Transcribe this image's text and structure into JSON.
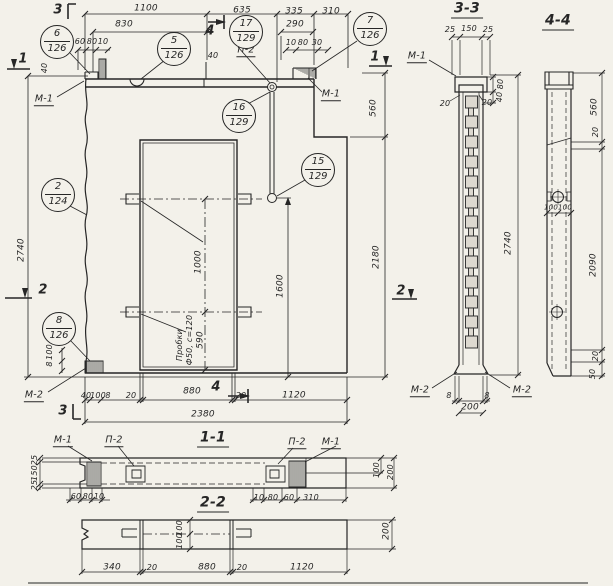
{
  "colors": {
    "paper": "#f3f1ea",
    "ink": "#262626",
    "cell": "#ddd9d0"
  },
  "view_titles": [
    {
      "t": "3-3",
      "x": 467,
      "y": 10,
      "n": "section-title-3-3"
    },
    {
      "t": "4-4",
      "x": 558,
      "y": 22,
      "n": "section-title-4-4"
    },
    {
      "t": "1-1",
      "x": 213,
      "y": 439,
      "n": "section-title-1-1"
    },
    {
      "t": "2-2",
      "x": 213,
      "y": 504,
      "n": "section-title-2-2"
    }
  ],
  "callouts": [
    {
      "top": "6",
      "bot": "126",
      "x": 57,
      "y": 42
    },
    {
      "top": "5",
      "bot": "126",
      "x": 174,
      "y": 49
    },
    {
      "top": "17",
      "bot": "129",
      "x": 246,
      "y": 32
    },
    {
      "top": "7",
      "bot": "126",
      "x": 370,
      "y": 29
    },
    {
      "top": "16",
      "bot": "129",
      "x": 239,
      "y": 116
    },
    {
      "top": "15",
      "bot": "129",
      "x": 318,
      "y": 170
    },
    {
      "top": "2",
      "bot": "124",
      "x": 58,
      "y": 195
    },
    {
      "top": "8",
      "bot": "126",
      "x": 59,
      "y": 329
    }
  ],
  "cut_labels": [
    {
      "t": "3",
      "x": 58,
      "y": 10
    },
    {
      "t": "4",
      "x": 210,
      "y": 31
    },
    {
      "t": "1",
      "x": 23,
      "y": 59
    },
    {
      "t": "1",
      "x": 375,
      "y": 57
    },
    {
      "t": "2",
      "x": 43,
      "y": 290
    },
    {
      "t": "2",
      "x": 401,
      "y": 291
    },
    {
      "t": "3",
      "x": 63,
      "y": 411
    },
    {
      "t": "4",
      "x": 216,
      "y": 387
    }
  ],
  "ref_labels": [
    {
      "t": "М-1",
      "x": 44,
      "y": 100
    },
    {
      "t": "М-1",
      "x": 331,
      "y": 95
    },
    {
      "t": "П-2",
      "x": 246,
      "y": 51
    },
    {
      "t": "М-2",
      "x": 34,
      "y": 396
    },
    {
      "t": "М-1",
      "x": 417,
      "y": 57
    },
    {
      "t": "М-2",
      "x": 420,
      "y": 391
    },
    {
      "t": "М-2",
      "x": 522,
      "y": 391
    },
    {
      "t": "М-1",
      "x": 63,
      "y": 441
    },
    {
      "t": "П-2",
      "x": 114,
      "y": 441
    },
    {
      "t": "П-2",
      "x": 297,
      "y": 443
    },
    {
      "t": "М-1",
      "x": 331,
      "y": 443
    }
  ],
  "texts": [
    {
      "t": "1100",
      "x": 146,
      "y": 9
    },
    {
      "t": "635",
      "x": 242,
      "y": 11
    },
    {
      "t": "335",
      "x": 294,
      "y": 12
    },
    {
      "t": "310",
      "x": 331,
      "y": 12
    },
    {
      "t": "830",
      "x": 124,
      "y": 25
    },
    {
      "t": "290",
      "x": 295,
      "y": 25
    },
    {
      "t": "60",
      "x": 80,
      "y": 42,
      "s": 8
    },
    {
      "t": "80",
      "x": 92,
      "y": 42,
      "s": 8
    },
    {
      "t": "10",
      "x": 103,
      "y": 42,
      "s": 8
    },
    {
      "t": "10",
      "x": 291,
      "y": 43,
      "s": 8
    },
    {
      "t": "80",
      "x": 303,
      "y": 43,
      "s": 8
    },
    {
      "t": "30",
      "x": 317,
      "y": 43,
      "s": 8
    },
    {
      "t": "40",
      "x": 213,
      "y": 56,
      "s": 8
    },
    {
      "t": "40",
      "x": 45,
      "y": 68,
      "r": 1,
      "s": 8
    },
    {
      "t": "2740",
      "x": 22,
      "y": 250,
      "r": 1
    },
    {
      "t": "100",
      "x": 50,
      "y": 352,
      "r": 1,
      "s": 8
    },
    {
      "t": "8",
      "x": 50,
      "y": 364,
      "r": 1,
      "s": 8
    },
    {
      "t": "560",
      "x": 374,
      "y": 108,
      "r": 1
    },
    {
      "t": "2180",
      "x": 377,
      "y": 257,
      "r": 1
    },
    {
      "t": "1000",
      "x": 199,
      "y": 262,
      "r": 1
    },
    {
      "t": "590",
      "x": 201,
      "y": 340,
      "r": 1
    },
    {
      "t": "1600",
      "x": 281,
      "y": 286,
      "r": 1
    },
    {
      "t": "Пробки",
      "x": 180,
      "y": 345,
      "r": 1,
      "s": 8,
      "n": "note-plugs-line1"
    },
    {
      "t": "Ф50, с=120",
      "x": 190,
      "y": 340,
      "r": 1,
      "s": 8,
      "n": "note-plugs-line2"
    },
    {
      "t": "40",
      "x": 86,
      "y": 396,
      "s": 8
    },
    {
      "t": "100",
      "x": 98,
      "y": 396,
      "s": 8
    },
    {
      "t": "8",
      "x": 108,
      "y": 396,
      "s": 8
    },
    {
      "t": "20",
      "x": 131,
      "y": 396,
      "s": 8
    },
    {
      "t": "880",
      "x": 192,
      "y": 392
    },
    {
      "t": "20",
      "x": 241,
      "y": 396,
      "s": 8
    },
    {
      "t": "1120",
      "x": 294,
      "y": 396
    },
    {
      "t": "2380",
      "x": 203,
      "y": 415
    },
    {
      "t": "25",
      "x": 450,
      "y": 30,
      "s": 8
    },
    {
      "t": "150",
      "x": 469,
      "y": 29,
      "s": 8
    },
    {
      "t": "25",
      "x": 488,
      "y": 30,
      "s": 8
    },
    {
      "t": "80",
      "x": 501,
      "y": 84,
      "r": 1,
      "s": 8
    },
    {
      "t": "40",
      "x": 500,
      "y": 97,
      "r": 1,
      "s": 8
    },
    {
      "t": "20",
      "x": 445,
      "y": 104,
      "s": 8
    },
    {
      "t": "20",
      "x": 487,
      "y": 103,
      "s": 8
    },
    {
      "t": "2740",
      "x": 509,
      "y": 243,
      "r": 1
    },
    {
      "t": "8",
      "x": 449,
      "y": 396,
      "s": 8
    },
    {
      "t": "8",
      "x": 487,
      "y": 396,
      "s": 8
    },
    {
      "t": "200",
      "x": 470,
      "y": 408
    },
    {
      "t": "560",
      "x": 595,
      "y": 107,
      "r": 1
    },
    {
      "t": "20",
      "x": 596,
      "y": 132,
      "r": 1,
      "s": 8
    },
    {
      "t": "100",
      "x": 551,
      "y": 208,
      "s": 7
    },
    {
      "t": "100",
      "x": 565,
      "y": 208,
      "s": 7
    },
    {
      "t": "2090",
      "x": 594,
      "y": 265,
      "r": 1
    },
    {
      "t": "20",
      "x": 596,
      "y": 356,
      "r": 1,
      "s": 8
    },
    {
      "t": "50",
      "x": 593,
      "y": 374,
      "r": 1,
      "s": 8
    },
    {
      "t": "25",
      "x": 35,
      "y": 460,
      "r": 1,
      "s": 8
    },
    {
      "t": "150",
      "x": 35,
      "y": 473,
      "r": 1,
      "s": 8
    },
    {
      "t": "25",
      "x": 35,
      "y": 485,
      "r": 1,
      "s": 8
    },
    {
      "t": "60",
      "x": 76,
      "y": 497,
      "s": 8
    },
    {
      "t": "80",
      "x": 88,
      "y": 497,
      "s": 8
    },
    {
      "t": "10",
      "x": 99,
      "y": 497,
      "s": 8
    },
    {
      "t": "10",
      "x": 259,
      "y": 498,
      "s": 8
    },
    {
      "t": "80",
      "x": 273,
      "y": 498,
      "s": 8
    },
    {
      "t": "60",
      "x": 289,
      "y": 498,
      "s": 8
    },
    {
      "t": "310",
      "x": 311,
      "y": 498,
      "s": 8
    },
    {
      "t": "100",
      "x": 377,
      "y": 470,
      "r": 1,
      "s": 8
    },
    {
      "t": "200",
      "x": 391,
      "y": 472,
      "r": 1,
      "s": 8
    },
    {
      "t": "100",
      "x": 180,
      "y": 528,
      "r": 1,
      "s": 8
    },
    {
      "t": "100",
      "x": 180,
      "y": 541,
      "r": 1,
      "s": 8
    },
    {
      "t": "340",
      "x": 112,
      "y": 568
    },
    {
      "t": "20",
      "x": 152,
      "y": 568,
      "s": 8
    },
    {
      "t": "880",
      "x": 207,
      "y": 568
    },
    {
      "t": "20",
      "x": 242,
      "y": 568,
      "s": 8
    },
    {
      "t": "1120",
      "x": 302,
      "y": 568
    },
    {
      "t": "200",
      "x": 387,
      "y": 531,
      "r": 1
    }
  ]
}
